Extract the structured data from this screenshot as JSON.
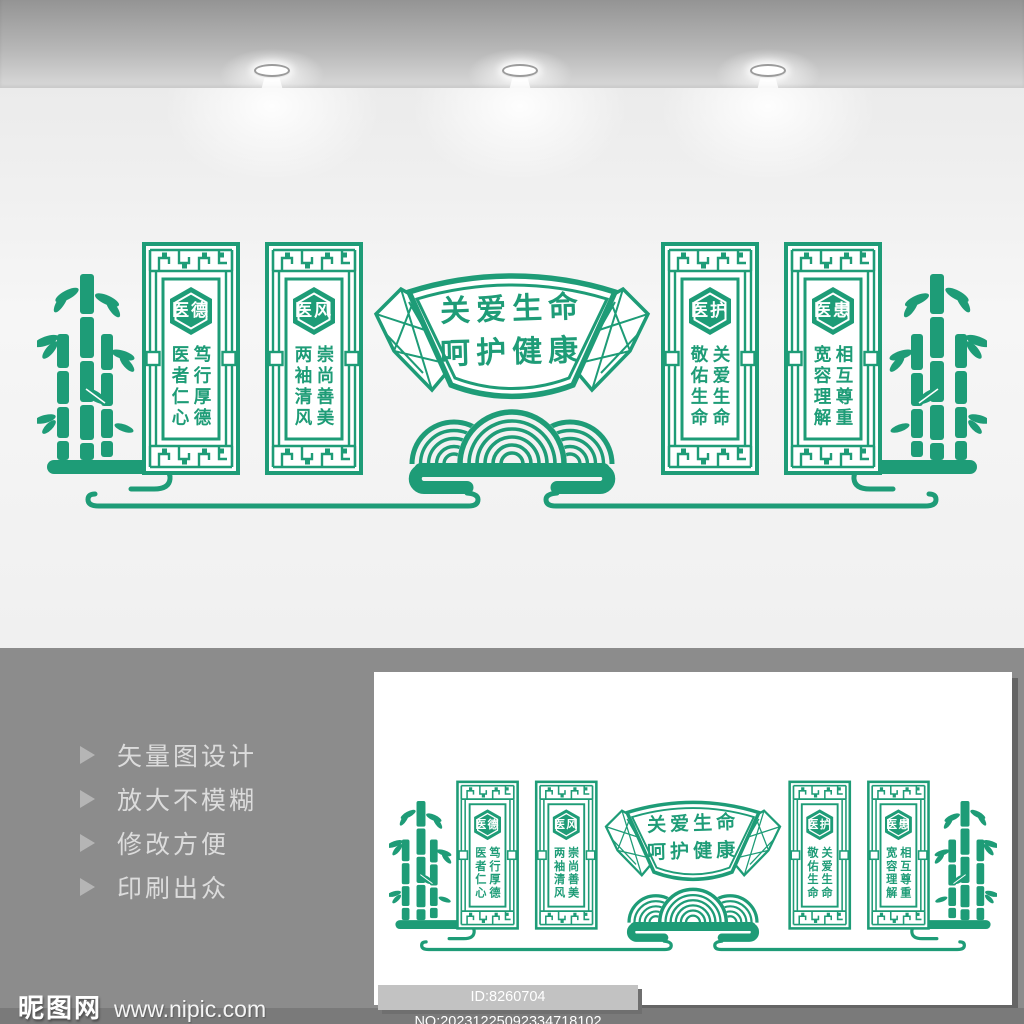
{
  "design": {
    "accent_color": "#1E9C77",
    "fan_title": {
      "line1": "关爱生命",
      "line2": "呵护健康"
    },
    "panels": [
      {
        "badge": "医德",
        "phrase_right": "笃行厚德",
        "phrase_left": "医者仁心"
      },
      {
        "badge": "医风",
        "phrase_right": "崇尚善美",
        "phrase_left": "两袖清风"
      },
      {
        "badge": "医护",
        "phrase_right": "关爱生命",
        "phrase_left": "敬佑生命"
      },
      {
        "badge": "医患",
        "phrase_right": "相互尊重",
        "phrase_left": "宽容理解"
      }
    ]
  },
  "features": {
    "items": [
      {
        "label": "矢量图设计"
      },
      {
        "label": "放大不模糊"
      },
      {
        "label": "修改方便"
      },
      {
        "label": "印刷出众"
      }
    ]
  },
  "footer": {
    "site_name": "昵图网",
    "site_url": "www.nipic.com",
    "image_id": "ID:8260704 NO:20231225092334718102",
    "triangle_color": "#b5b5b5"
  }
}
